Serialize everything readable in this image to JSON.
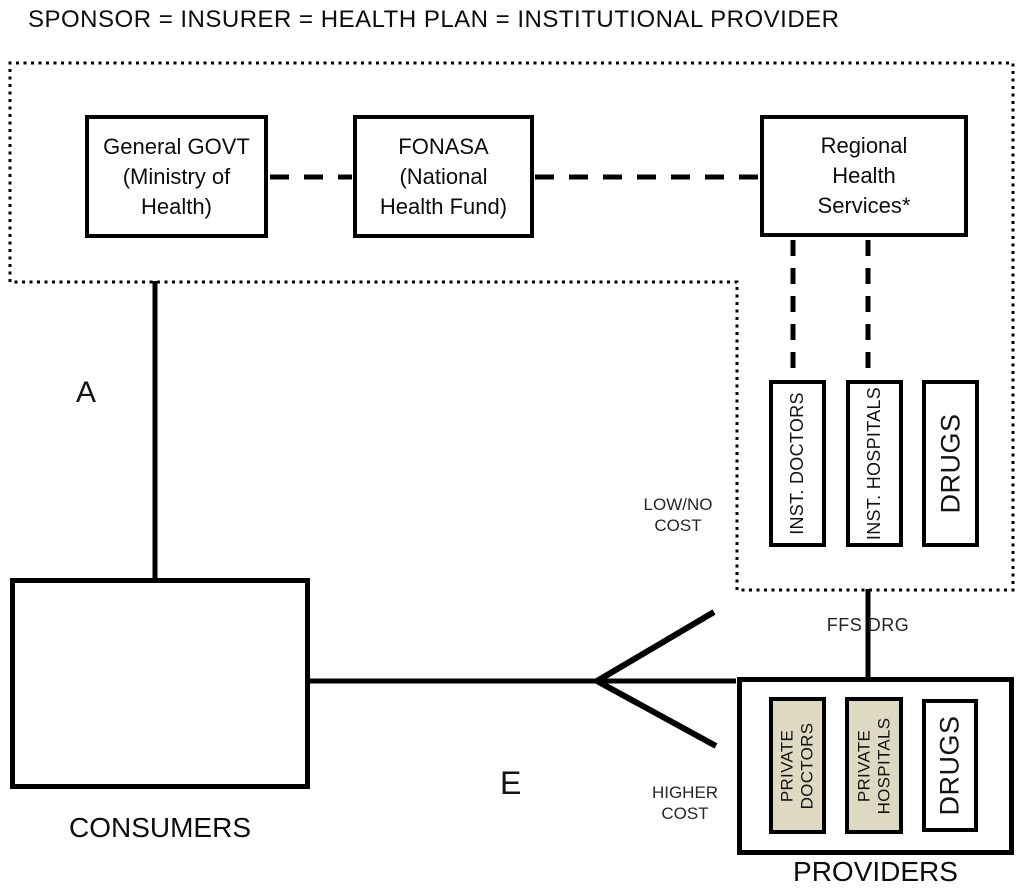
{
  "title": "SPONSOR = INSURER = HEALTH PLAN = INSTITUTIONAL PROVIDER",
  "colors": {
    "line": "#000000",
    "tan_fill": "#DDD9C3",
    "background": "#ffffff"
  },
  "sponsor_group": {
    "general_govt": "General GOVT (Ministry of Health)",
    "fonasa": "FONASA (National Health Fund)",
    "regional_health_services": "Regional Health Services*",
    "inst_doctors": "INST. DOCTORS",
    "inst_hospitals": "INST. HOSPITALS",
    "drugs": "DRUGS",
    "low_no_cost": "LOW/NO\nCOST"
  },
  "consumers": {
    "label": "CONSUMERS"
  },
  "providers_group": {
    "private_doctors": "PRIVATE\nDOCTORS",
    "private_hospitals": "PRIVATE\nHOSPITALS",
    "drugs": "DRUGS",
    "label": "PROVIDERS"
  },
  "edge_labels": {
    "a": "A",
    "e": "E",
    "ffs_drg": "FFS DRG",
    "higher_cost": "HIGHER\nCOST"
  }
}
